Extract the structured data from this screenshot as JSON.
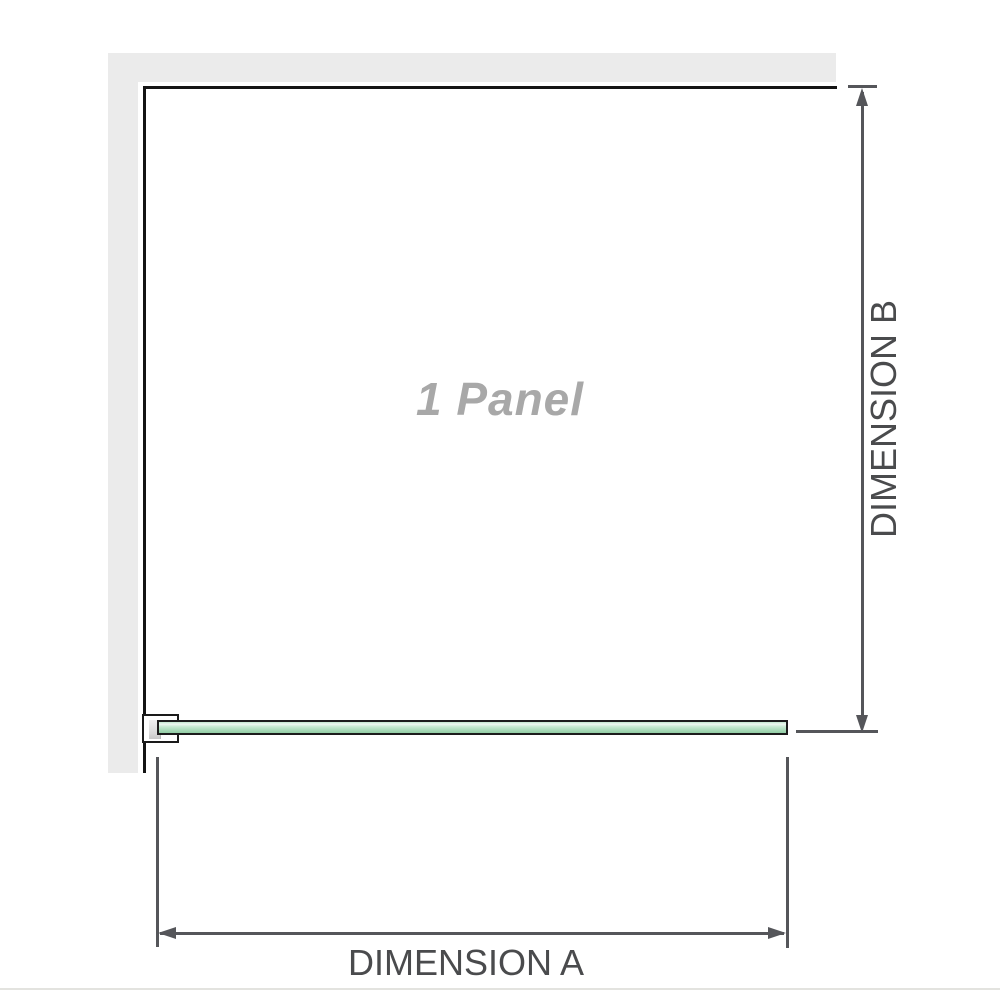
{
  "diagram": {
    "panel_label": "1 Panel",
    "dimension_a_label": "DIMENSION A",
    "dimension_b_label": "DIMENSION B"
  },
  "colors": {
    "background": "#ffffff",
    "wall_fill": "#ebebeb",
    "room_outline": "#141414",
    "dimension_gray": "#55565a",
    "dimension_label_gray": "#4a4b4d",
    "panel_label_gray": "#a8a8a8",
    "glass_border": "#1c1c1c",
    "glass_green_highlight": "#eef8f1",
    "glass_green": "#abdbba",
    "glass_green_dark": "#92cda4",
    "bracket_fill": "#ffffff",
    "bracket_spacer_gray": "#d9d9d9",
    "footer_line": "#e3e3df"
  }
}
